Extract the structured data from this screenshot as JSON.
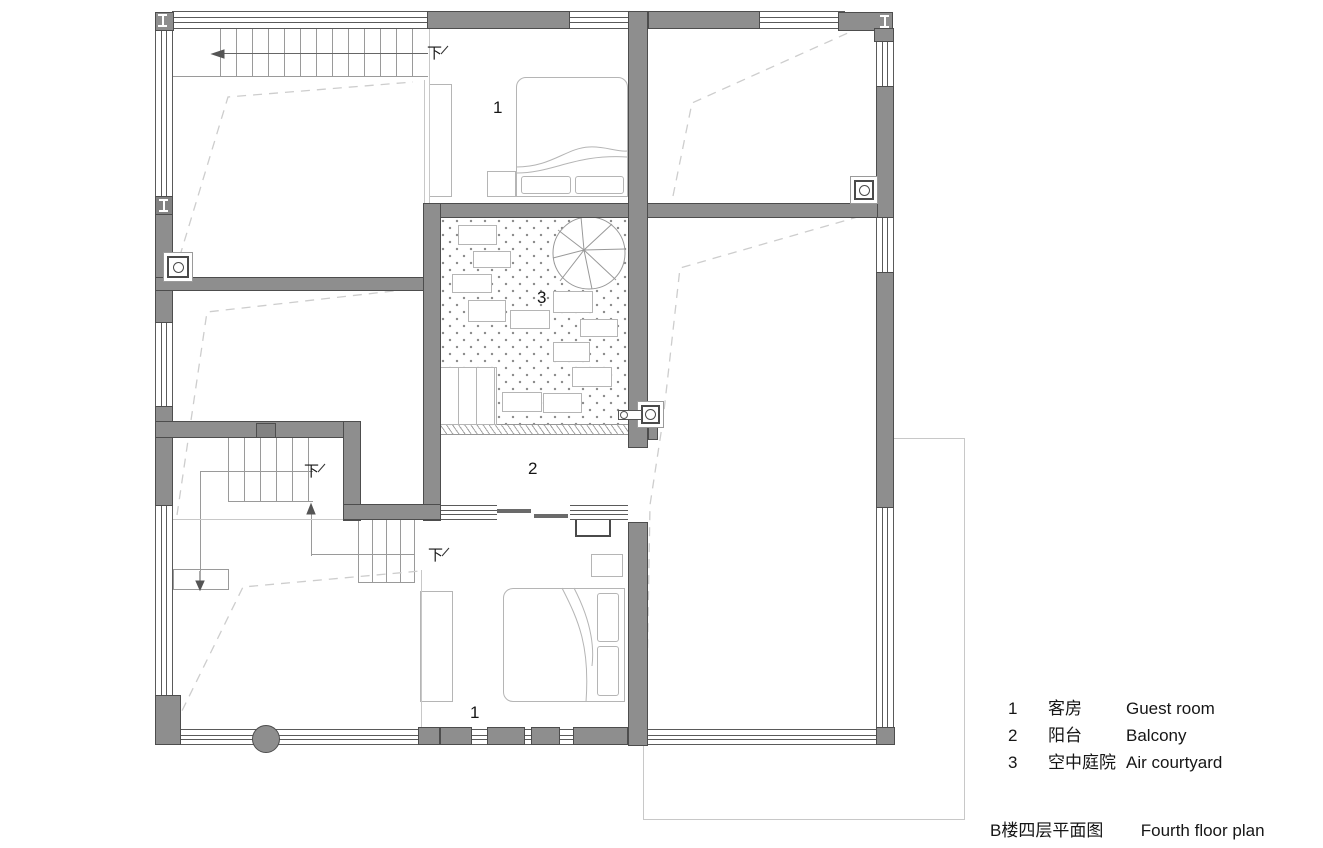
{
  "colors": {
    "wall": "#8e8e8e",
    "wall_border": "#4d4d4d",
    "window_line": "#5a5a5a",
    "furniture": "#b5b5b5",
    "stair": "#9a9a9a",
    "dash": "#cdcdcd",
    "thin": "#c8c8c8",
    "dot": "#8a8a8a",
    "ink": "#161616"
  },
  "plan": {
    "labels": {
      "down": "下",
      "guest_room": "1",
      "balcony": "2",
      "air_courtyard": "3"
    }
  },
  "legend": {
    "rows": [
      {
        "num": "1",
        "zh": "客房",
        "en": "Guest room"
      },
      {
        "num": "2",
        "zh": "阳台",
        "en": "Balcony"
      },
      {
        "num": "3",
        "zh": "空中庭院",
        "en": "Air courtyard"
      }
    ]
  },
  "title": {
    "zh": "B楼四层平面图",
    "en": "Fourth floor plan"
  }
}
